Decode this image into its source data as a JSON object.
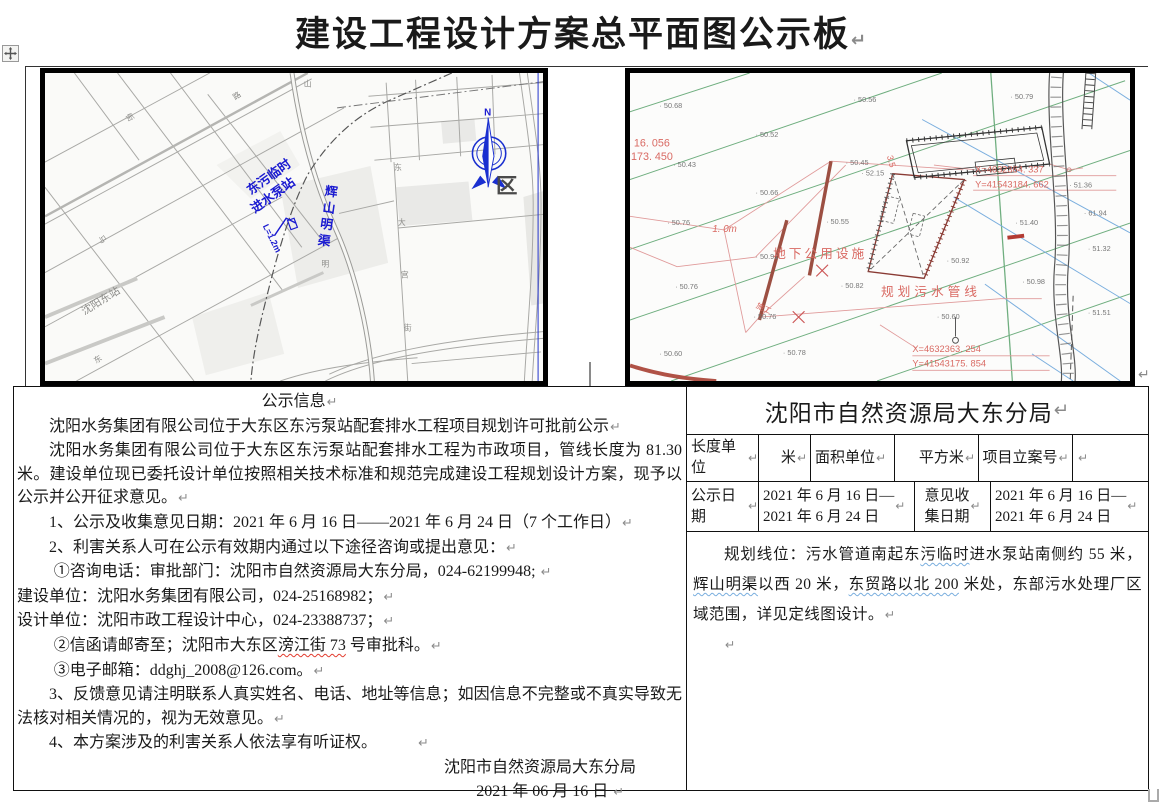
{
  "formatting_mark": "↵",
  "title": {
    "text": "建设工程设计方案总平面图公示板"
  },
  "colors": {
    "map_label_blue": "#1a1ad0",
    "compass_blue": "#1a2fd0",
    "plan_green": "#6fae7f",
    "plan_blue": "#7aaede",
    "plan_red": "#d96a63",
    "plan_maroon": "#9c4f42",
    "wavy_blue": "#79aede",
    "wavy_red": "#e23b2e",
    "frame_black": "#000000",
    "pilcrow_gray": "#8a8a8a"
  },
  "left_map": {
    "labels": [
      {
        "t": "N",
        "x": 448,
        "y": 44,
        "c": "blu",
        "s": 10,
        "b": 1
      },
      {
        "t": "区",
        "x": 460,
        "y": 124,
        "c": "dark",
        "s": 22,
        "b": 1
      },
      {
        "t": "东污临时",
        "x": 210,
        "y": 126,
        "r": -36,
        "c": "blu",
        "s": 13,
        "b": 1
      },
      {
        "t": "进水泵站",
        "x": 214,
        "y": 145,
        "r": -36,
        "c": "blu",
        "s": 13,
        "b": 1
      },
      {
        "t": "辉山明渠",
        "x": 285,
        "y": 126,
        "c": "blu",
        "s": 13,
        "b": 1,
        "v": 1,
        "r": 8
      },
      {
        "t": "L=1.2m",
        "x": 222,
        "y": 158,
        "r": 64,
        "c": "blu",
        "s": 9,
        "b": 1
      },
      {
        "t": "沈阳东站",
        "x": 40,
        "y": 250,
        "r": -32,
        "c": "gray",
        "s": 11
      },
      {
        "t": "山",
        "x": 264,
        "y": 14,
        "c": "gray",
        "s": 8
      },
      {
        "t": "路",
        "x": 194,
        "y": 28,
        "r": -35,
        "c": "gray",
        "s": 8
      },
      {
        "t": "街",
        "x": 82,
        "y": 44,
        "r": 55,
        "c": "gray",
        "s": 8
      },
      {
        "t": "马",
        "x": 54,
        "y": 170,
        "r": 55,
        "c": "gray",
        "s": 8
      },
      {
        "t": "东",
        "x": 356,
        "y": 100,
        "c": "gray",
        "s": 8
      },
      {
        "t": "大",
        "x": 360,
        "y": 157,
        "c": "gray",
        "s": 8
      },
      {
        "t": "宫",
        "x": 363,
        "y": 211,
        "c": "gray",
        "s": 8
      },
      {
        "t": "街",
        "x": 366,
        "y": 266,
        "c": "gray",
        "s": 8
      },
      {
        "t": "东",
        "x": 52,
        "y": 300,
        "r": -33,
        "c": "gray",
        "s": 8
      },
      {
        "t": "明",
        "x": 282,
        "y": 200,
        "c": "gray",
        "s": 8
      }
    ]
  },
  "right_map": {
    "elevations": [
      {
        "x": 30,
        "y": 36,
        "v": "50.68"
      },
      {
        "x": 228,
        "y": 30,
        "v": "50.56"
      },
      {
        "x": 388,
        "y": 27,
        "v": "50.79"
      },
      {
        "x": 128,
        "y": 66,
        "v": "50.52"
      },
      {
        "x": 44,
        "y": 97,
        "v": "50.43"
      },
      {
        "x": 220,
        "y": 95,
        "v": "50.45"
      },
      {
        "x": 236,
        "y": 106,
        "v": "52.15"
      },
      {
        "x": 128,
        "y": 126,
        "v": "50.66"
      },
      {
        "x": 38,
        "y": 157,
        "v": "50.76"
      },
      {
        "x": 200,
        "y": 156,
        "v": "50.55"
      },
      {
        "x": 393,
        "y": 157,
        "v": "51.40"
      },
      {
        "x": 448,
        "y": 118,
        "v": "51.36"
      },
      {
        "x": 463,
        "y": 147,
        "v": "61.94"
      },
      {
        "x": 128,
        "y": 192,
        "v": "50.91"
      },
      {
        "x": 46,
        "y": 223,
        "v": "50.76"
      },
      {
        "x": 215,
        "y": 222,
        "v": "50.82"
      },
      {
        "x": 323,
        "y": 196,
        "v": "50.92"
      },
      {
        "x": 400,
        "y": 218,
        "v": "50.98"
      },
      {
        "x": 313,
        "y": 254,
        "v": "50.60"
      },
      {
        "x": 126,
        "y": 254,
        "v": "50.76"
      },
      {
        "x": 30,
        "y": 292,
        "v": "50.60"
      },
      {
        "x": 156,
        "y": 291,
        "v": "50.78"
      },
      {
        "x": 467,
        "y": 184,
        "v": "51.32"
      },
      {
        "x": 467,
        "y": 250,
        "v": "51.51"
      }
    ],
    "red_labels": [
      {
        "t": "16. 056",
        "x": 4,
        "y": 76,
        "s": 11
      },
      {
        "t": "173. 450",
        "x": 1,
        "y": 90,
        "s": 11
      },
      {
        "t": "X=4632364. 337",
        "x": 352,
        "y": 103,
        "s": 9.5
      },
      {
        "t": "Y=41543184. 662",
        "x": 352,
        "y": 118,
        "s": 9.5
      },
      {
        "t": "地下公用设施",
        "x": 146,
        "y": 191,
        "s": 13,
        "ls": 3
      },
      {
        "t": "1. 0m",
        "x": 84,
        "y": 164,
        "s": 10,
        "i": 1
      },
      {
        "t": "规划污水管线",
        "x": 256,
        "y": 230,
        "s": 13,
        "ls": 4
      },
      {
        "t": "X=4632363. 254",
        "x": 288,
        "y": 288,
        "s": 9.5
      },
      {
        "t": "Y=41543175. 854",
        "x": 288,
        "y": 303,
        "s": 9.5
      },
      {
        "t": "3.5",
        "x": 262,
        "y": 86,
        "s": 9,
        "r": 75
      },
      {
        "t": "施工",
        "x": 128,
        "y": 242,
        "s": 8,
        "r": 25
      }
    ]
  },
  "notice": {
    "paragraphs": [
      {
        "align": "center",
        "segs": [
          {
            "t": "公示信息"
          }
        ],
        "pilc": true
      },
      {
        "indent": 2,
        "segs": [
          {
            "t": "沈阳水务集团有限公司位于大东区东污泵站配套排水工程项目规划许可批前公示"
          }
        ],
        "pilc": true
      },
      {
        "indent": 2,
        "justify": true,
        "segs": [
          {
            "t": "沈阳水务集团有限公司位于大东区东污泵站配套排水工程为市政项目，管线长度为 81.30 米。建设单位现已委托设计单位按照相关技术标准和规范完成建设工程规划设计方案，现予以公示并公开征求意见。"
          }
        ],
        "pilc": true
      },
      {
        "indent": 2,
        "segs": [
          {
            "t": "1、公示及收集意见日期：2021 年 6 月 16 日——2021 年 6 月 24 日（7 个工作日）"
          }
        ],
        "pilc": true
      },
      {
        "indent": 2,
        "segs": [
          {
            "t": "2、利害关系人可在公示有效期内通过以下途径咨询或提出意见："
          }
        ],
        "pilc": true
      },
      {
        "indent": 2.3,
        "segs": [
          {
            "t": "①咨询电话：审批部门：沈阳市自然资源局大东分局，024-62199948; "
          }
        ],
        "pilc": true
      },
      {
        "indent": 0,
        "segs": [
          {
            "t": "建设单位：沈阳水务集团有限公司，024-25168982；"
          }
        ],
        "pilc": true
      },
      {
        "indent": 0,
        "segs": [
          {
            "t": "设计单位：沈阳市政工程设计中心，024-23388737；"
          }
        ],
        "pilc": true
      },
      {
        "indent": 2.3,
        "segs": [
          {
            "t": "②信函请邮寄至；沈阳市大东区"
          },
          {
            "t": "滂江街 73",
            "wavy": "red"
          },
          {
            "t": " 号审批科。"
          }
        ],
        "pilc": true
      },
      {
        "indent": 2.3,
        "segs": [
          {
            "t": "③电子邮箱：ddghj_2008@126.com。"
          }
        ],
        "pilc": true
      },
      {
        "indent": 2,
        "justify": true,
        "segs": [
          {
            "t": "3、反馈意见请注明联系人真实姓名、电话、地址等信息；如因信息不完整或不真实导致无法核对相关情况的，视为无效意见。"
          }
        ],
        "pilc": true
      },
      {
        "indent": 2,
        "segs": [
          {
            "t": "4、本方案涉及的利害关系人依法享有听证权。　　　"
          }
        ],
        "pilc": true
      },
      {
        "align": "right",
        "pr": 46,
        "segs": [
          {
            "t": "沈阳市自然资源局大东分局"
          }
        ]
      },
      {
        "align": "right",
        "pr": 58,
        "segs": [
          {
            "t": "2021 年 06 月 16 日 "
          }
        ],
        "pilc": true
      }
    ]
  },
  "agency": {
    "header": "沈阳市自然资源局大东分局",
    "row1": [
      "长度单位",
      "米",
      "面积单位",
      "平方米",
      "项目立案号",
      ""
    ],
    "row2": [
      "公示日期",
      "2021 年 6 月 16 日—\n2021 年 6 月 24 日",
      "意见收\n集日期",
      "2021 年 6 月 16 日—\n2021 年 6 月 24 日"
    ],
    "paragraphs": [
      {
        "indent": 2,
        "justify": true,
        "segs": [
          {
            "t": "规划线位：污水管道南起东"
          },
          {
            "t": "污临时",
            "wavy": "blue"
          },
          {
            "t": "进水泵站南侧约 55 米，"
          },
          {
            "t": "辉山明渠",
            "wavy": "blue"
          },
          {
            "t": "以西 20 米，"
          },
          {
            "t": "东贸路以北 200",
            "wavy": "blue"
          },
          {
            "t": " 米处，东部污水处理厂区域范围，详见定线图设计。"
          }
        ],
        "pilc": true
      },
      {
        "indent": 2,
        "segs": [],
        "pilc": true
      }
    ]
  }
}
